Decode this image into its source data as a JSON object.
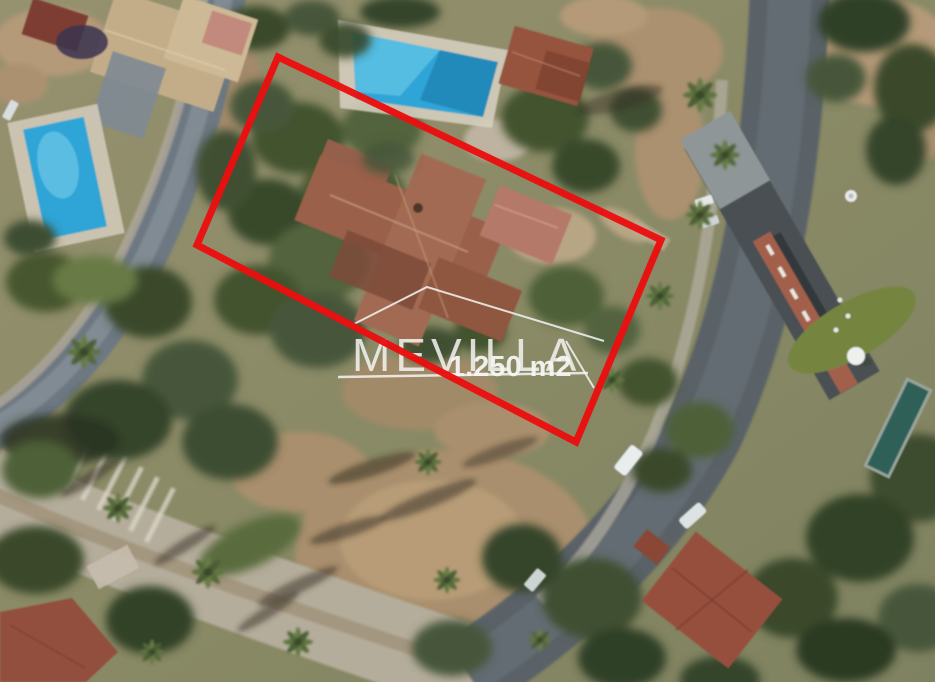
{
  "watermark": {
    "brand": "MEVILLA",
    "area_label": "1.250 m2",
    "color": "#f5f5f3"
  },
  "boundary": {
    "color": "#ea1010",
    "stroke_width": 7
  },
  "palette": {
    "pool_water": "#2fa5d6",
    "pool_water_deep": "#1f85b5",
    "lap_pool": "#2e6058",
    "road_asphalt": "#5a6268",
    "road_avenue": "#b5ad9b",
    "road_street": "#6d7882",
    "earth": "#b0976f",
    "villa_roof": "#9a6049",
    "neighbor_roof_tan": "#c3ad89",
    "neighbor_roof_red": "#94493a",
    "modern_roof": "#4a5053",
    "canopy_dark": "#35452c",
    "canopy": "#4c5e38",
    "canopy_light": "#6d8049"
  }
}
